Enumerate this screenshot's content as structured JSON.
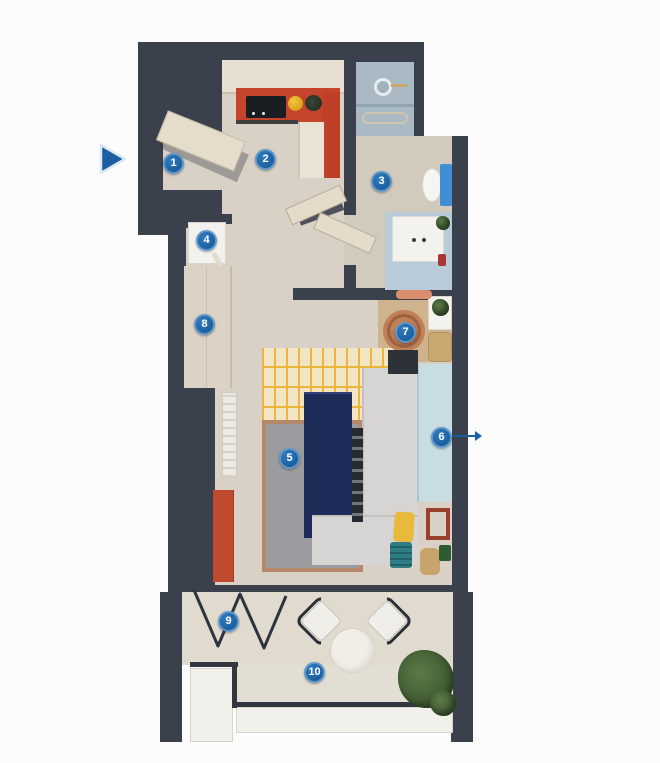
{
  "annotations": {
    "markers": [
      {
        "number": "1",
        "x": 173,
        "y": 163
      },
      {
        "number": "2",
        "x": 265,
        "y": 159
      },
      {
        "number": "3",
        "x": 381,
        "y": 181
      },
      {
        "number": "4",
        "x": 206,
        "y": 240
      },
      {
        "number": "5",
        "x": 289,
        "y": 458
      },
      {
        "number": "6",
        "x": 441,
        "y": 437
      },
      {
        "number": "7",
        "x": 405,
        "y": 332
      },
      {
        "number": "8",
        "x": 204,
        "y": 324
      },
      {
        "number": "9",
        "x": 228,
        "y": 621
      },
      {
        "number": "10",
        "x": 314,
        "y": 672
      }
    ],
    "entrance_arrow": {
      "x": 96,
      "y": 142,
      "direction": "right"
    },
    "marker6_leader": {
      "x1": 452,
      "y1": 436,
      "x2": 482,
      "y2": 436
    }
  },
  "colors": {
    "wall": "#3a414d",
    "floor_beige": "#d9d1c6",
    "terrace_floor": "#e0dacf",
    "shower_floor": "#a9bac5",
    "vanity_floor": "#b7ccd8",
    "kitchen_red": "#c4452c",
    "sofa_gray": "#d6d5d3",
    "rug_gray": "#9c9ca0",
    "rug_yellow_line": "#e9b434",
    "navy_table": "#1e2c5a",
    "sideboard_blue": "#c7dde2",
    "marker_fill": "#14538f",
    "marker_ring": "#5f97c9",
    "arrow_blue": "#1b5fa3",
    "plant_green": "#3c5530"
  }
}
